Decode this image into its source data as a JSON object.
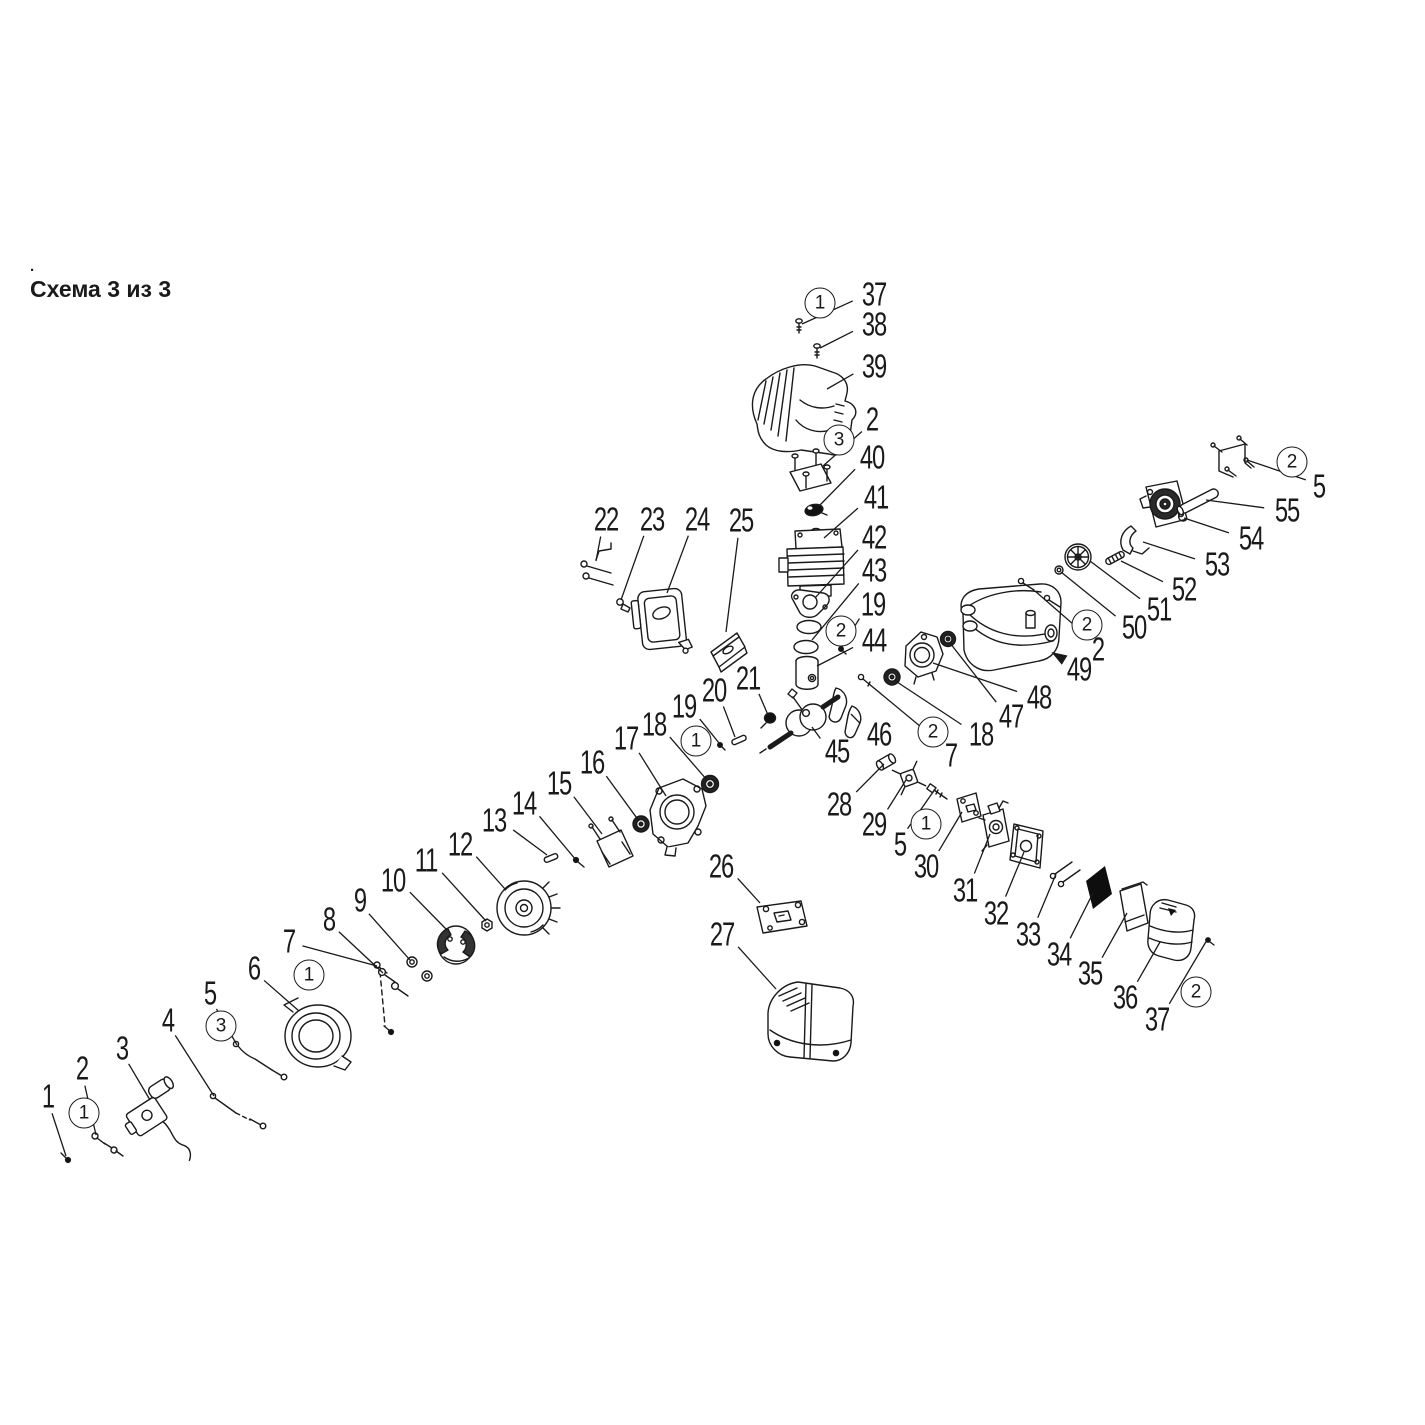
{
  "title": {
    "text": "Схема 3 из 3",
    "mark": "."
  },
  "colors": {
    "ink": "#1a1a1a",
    "background": "#ffffff"
  },
  "diagram": {
    "labels": [
      {
        "t": "1",
        "x": 48,
        "y": 1096,
        "tx": 66,
        "ty": 1156
      },
      {
        "t": "2",
        "x": 82,
        "y": 1068,
        "tx": 96,
        "ty": 1135
      },
      {
        "t": "3",
        "x": 122,
        "y": 1048,
        "tx": 150,
        "ty": 1100
      },
      {
        "t": "4",
        "x": 168,
        "y": 1020,
        "tx": 214,
        "ty": 1096
      },
      {
        "t": "5",
        "x": 210,
        "y": 993,
        "tx": 237,
        "ty": 1045
      },
      {
        "t": "6",
        "x": 254,
        "y": 968,
        "tx": 299,
        "ty": 1011
      },
      {
        "t": "7",
        "x": 289,
        "y": 941,
        "tx": 377,
        "ty": 966
      },
      {
        "t": "8",
        "x": 329,
        "y": 919,
        "tx": 383,
        "ty": 973
      },
      {
        "t": "9",
        "x": 360,
        "y": 900,
        "tx": 410,
        "ty": 960
      },
      {
        "t": "10",
        "x": 393,
        "y": 880,
        "tx": 446,
        "ty": 929
      },
      {
        "t": "11",
        "x": 426,
        "y": 860,
        "tx": 486,
        "ty": 921
      },
      {
        "t": "12",
        "x": 460,
        "y": 844,
        "tx": 505,
        "ty": 889
      },
      {
        "t": "13",
        "x": 494,
        "y": 820,
        "tx": 547,
        "ty": 855
      },
      {
        "t": "14",
        "x": 524,
        "y": 803,
        "tx": 576,
        "ty": 860
      },
      {
        "t": "15",
        "x": 559,
        "y": 783,
        "tx": 602,
        "ty": 834
      },
      {
        "t": "16",
        "x": 592,
        "y": 762,
        "tx": 639,
        "ty": 821
      },
      {
        "t": "17",
        "x": 626,
        "y": 738,
        "tx": 666,
        "ty": 796
      },
      {
        "t": "18",
        "x": 654,
        "y": 724,
        "tx": 707,
        "ty": 780
      },
      {
        "t": "19",
        "x": 684,
        "y": 706,
        "tx": 719,
        "ty": 743
      },
      {
        "t": "20",
        "x": 714,
        "y": 690,
        "tx": 735,
        "ty": 737
      },
      {
        "t": "21",
        "x": 748,
        "y": 678,
        "tx": 768,
        "ty": 715
      },
      {
        "t": "22",
        "x": 606,
        "y": 519,
        "tx": 596,
        "ty": 561
      },
      {
        "t": "23",
        "x": 652,
        "y": 519,
        "tx": 621,
        "ty": 600
      },
      {
        "t": "24",
        "x": 697,
        "y": 519,
        "tx": 667,
        "ty": 593
      },
      {
        "t": "25",
        "x": 741,
        "y": 520,
        "tx": 726,
        "ty": 632
      },
      {
        "t": "37",
        "x": 874,
        "y": 294,
        "tx": 802,
        "ty": 324
      },
      {
        "t": "38",
        "x": 874,
        "y": 324,
        "tx": 820,
        "ty": 348
      },
      {
        "t": "39",
        "x": 874,
        "y": 366,
        "tx": 827,
        "ty": 389
      },
      {
        "t": "2",
        "x": 872,
        "y": 419,
        "tx": 823,
        "ty": 466
      },
      {
        "t": "40",
        "x": 872,
        "y": 457,
        "tx": 819,
        "ty": 506
      },
      {
        "t": "41",
        "x": 876,
        "y": 497,
        "tx": 824,
        "ty": 538
      },
      {
        "t": "42",
        "x": 874,
        "y": 537,
        "tx": 815,
        "ty": 598
      },
      {
        "t": "43",
        "x": 874,
        "y": 570,
        "tx": 812,
        "ty": 640
      },
      {
        "t": "19",
        "x": 873,
        "y": 604,
        "tx": 841,
        "ty": 648
      },
      {
        "t": "44",
        "x": 874,
        "y": 640,
        "tx": 817,
        "ty": 666
      },
      {
        "t": "45",
        "x": 837,
        "y": 751,
        "tx": 812,
        "ty": 727
      },
      {
        "t": "46",
        "x": 879,
        "y": 734,
        "tx": 851,
        "ty": 714
      },
      {
        "t": "26",
        "x": 721,
        "y": 866,
        "tx": 760,
        "ty": 903
      },
      {
        "t": "27",
        "x": 722,
        "y": 934,
        "tx": 776,
        "ty": 989
      },
      {
        "t": "28",
        "x": 839,
        "y": 804,
        "tx": 884,
        "ty": 764
      },
      {
        "t": "29",
        "x": 874,
        "y": 824,
        "tx": 906,
        "ty": 780
      },
      {
        "t": "5",
        "x": 900,
        "y": 844,
        "tx": 933,
        "ty": 792
      },
      {
        "t": "30",
        "x": 926,
        "y": 866,
        "tx": 962,
        "ty": 812
      },
      {
        "t": "31",
        "x": 965,
        "y": 890,
        "tx": 990,
        "ty": 834
      },
      {
        "t": "32",
        "x": 996,
        "y": 913,
        "tx": 1024,
        "ty": 852
      },
      {
        "t": "33",
        "x": 1028,
        "y": 934,
        "tx": 1056,
        "ty": 874
      },
      {
        "t": "34",
        "x": 1059,
        "y": 954,
        "tx": 1093,
        "ty": 893
      },
      {
        "t": "35",
        "x": 1090,
        "y": 973,
        "tx": 1127,
        "ty": 913
      },
      {
        "t": "36",
        "x": 1125,
        "y": 997,
        "tx": 1160,
        "ty": 942
      },
      {
        "t": "37",
        "x": 1157,
        "y": 1019,
        "tx": 1207,
        "ty": 940
      },
      {
        "t": "7",
        "x": 951,
        "y": 755,
        "tx": 880,
        "ty": 693
      },
      {
        "t": "18",
        "x": 981,
        "y": 734,
        "tx": 894,
        "ty": 680
      },
      {
        "t": "47",
        "x": 1011,
        "y": 716,
        "tx": 950,
        "ty": 643
      },
      {
        "t": "48",
        "x": 1039,
        "y": 697,
        "tx": 933,
        "ty": 663
      },
      {
        "t": "49",
        "x": 1079,
        "y": 669,
        "tx": 1053,
        "ty": 653,
        "arrow": 1
      },
      {
        "t": "2",
        "x": 1098,
        "y": 649,
        "tx": 1035,
        "ty": 591
      },
      {
        "t": "50",
        "x": 1134,
        "y": 627,
        "tx": 1061,
        "ty": 572
      },
      {
        "t": "51",
        "x": 1159,
        "y": 609,
        "tx": 1090,
        "ty": 561
      },
      {
        "t": "52",
        "x": 1184,
        "y": 589,
        "tx": 1121,
        "ty": 561
      },
      {
        "t": "53",
        "x": 1217,
        "y": 564,
        "tx": 1143,
        "ty": 542
      },
      {
        "t": "54",
        "x": 1251,
        "y": 538,
        "tx": 1184,
        "ty": 518
      },
      {
        "t": "55",
        "x": 1287,
        "y": 510,
        "tx": 1206,
        "ty": 500
      },
      {
        "t": "5",
        "x": 1319,
        "y": 486,
        "tx": 1247,
        "ty": 460
      }
    ],
    "badges": [
      {
        "t": "1",
        "x": 820,
        "y": 303
      },
      {
        "t": "3",
        "x": 839,
        "y": 440
      },
      {
        "t": "2",
        "x": 841,
        "y": 631
      },
      {
        "t": "1",
        "x": 696,
        "y": 741
      },
      {
        "t": "2",
        "x": 933,
        "y": 732
      },
      {
        "t": "2",
        "x": 1087,
        "y": 625
      },
      {
        "t": "2",
        "x": 1292,
        "y": 462
      },
      {
        "t": "1",
        "x": 926,
        "y": 824
      },
      {
        "t": "2",
        "x": 1196,
        "y": 992
      },
      {
        "t": "1",
        "x": 309,
        "y": 975
      },
      {
        "t": "3",
        "x": 221,
        "y": 1026
      },
      {
        "t": "1",
        "x": 84,
        "y": 1113
      }
    ]
  }
}
